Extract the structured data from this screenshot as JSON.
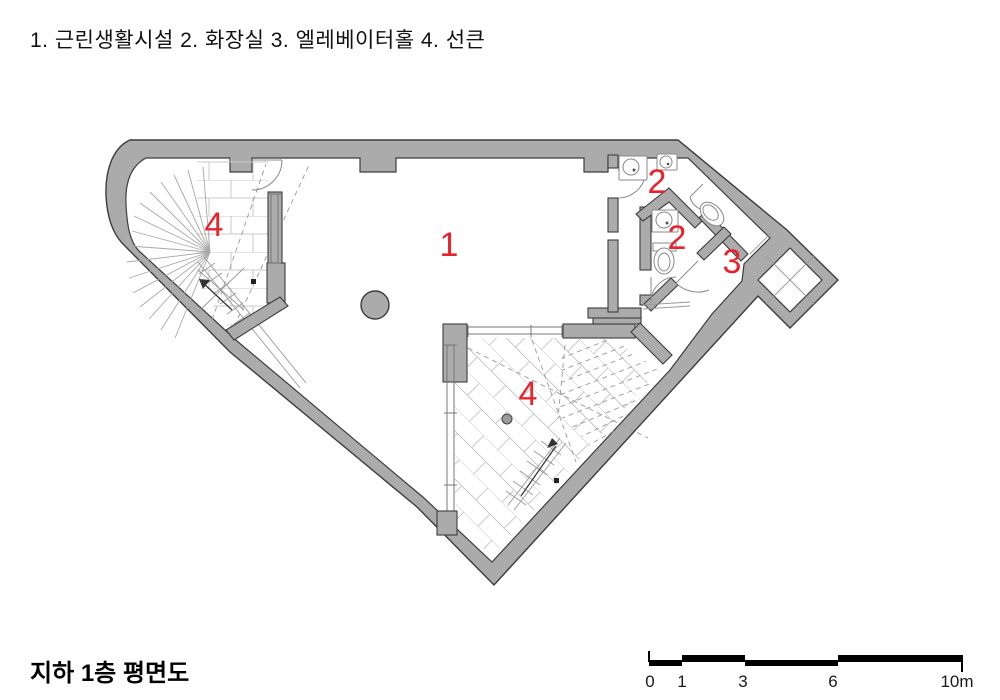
{
  "legend_text": "1. 근린생활시설  2. 화장실  3. 엘레베이터홀  4. 선큰",
  "title": "지하 1층 평면도",
  "scale_bar": {
    "labels": [
      "0",
      "1",
      "3",
      "6",
      "10m"
    ]
  },
  "rooms": {
    "r1": "1",
    "r2_upper": "2",
    "r2_lower": "2",
    "r3": "3",
    "r4_upper": "4",
    "r4_lower": "4"
  },
  "colors": {
    "wall_fill": "#ababab",
    "wall_outline": "#3c3c3c",
    "label_red": "#e8232b"
  }
}
